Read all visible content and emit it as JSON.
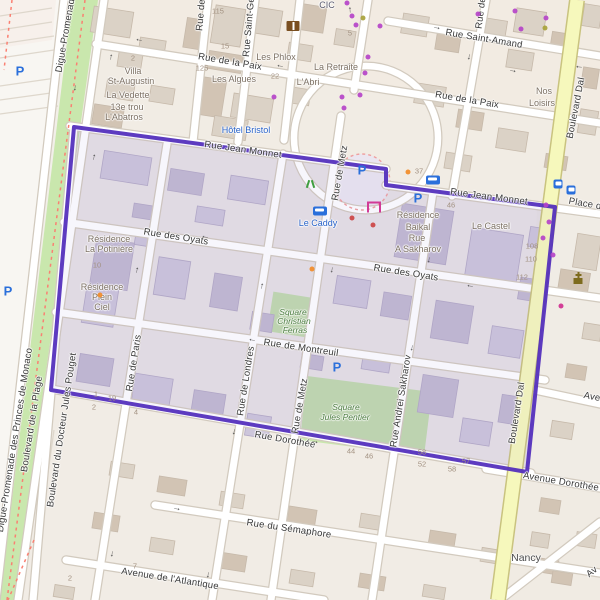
{
  "map_type": "street-map",
  "colors": {
    "background": "#f2efe9",
    "boundary_purple": "#5531bd",
    "boundary_fill": "rgba(126,110,198,0.10)",
    "major_road_yellow": "#f6f8bc",
    "park_green": "#c9e7ad",
    "poi_blue": "#2862c8",
    "building_outside": "#dbd2c6",
    "building_inside": "#cdc6db"
  },
  "glyphs": {
    "oneway_arrow": "→",
    "parking": "P"
  },
  "labels": [
    {
      "text": "Rue Saint-Amand",
      "x": 484,
      "y": 39,
      "rot": 9.5,
      "cls": "st"
    },
    {
      "text": "Rue de la Paix",
      "x": 230,
      "y": 62,
      "rot": 9.5,
      "cls": "st"
    },
    {
      "text": "Rue de la Paix",
      "x": 467,
      "y": 100,
      "rot": 9.5,
      "cls": "st"
    },
    {
      "text": "Rue Jean Monnet",
      "x": 243,
      "y": 150,
      "rot": 8,
      "cls": "st"
    },
    {
      "text": "Rue Jean Monnet",
      "x": 489,
      "y": 197,
      "rot": 7.5,
      "cls": "st"
    },
    {
      "text": "Place d",
      "x": 585,
      "y": 204,
      "rot": 10,
      "cls": "st"
    },
    {
      "text": "Rue des Oyats",
      "x": 176,
      "y": 237,
      "rot": 9,
      "cls": "st"
    },
    {
      "text": "Rue des Oyats",
      "x": 406,
      "y": 273,
      "rot": 9,
      "cls": "st"
    },
    {
      "text": "Rue de Montreuil",
      "x": 301,
      "y": 348,
      "rot": 8.5,
      "cls": "st"
    },
    {
      "text": "Rue Dorothée",
      "x": 285,
      "y": 440,
      "rot": 10,
      "cls": "st"
    },
    {
      "text": "Avenue Dorothée",
      "x": 561,
      "y": 482,
      "rot": 9.5,
      "cls": "st"
    },
    {
      "text": "Ave",
      "x": 592,
      "y": 397,
      "rot": 11,
      "cls": "st"
    },
    {
      "text": "Rue du Sémaphore",
      "x": 289,
      "y": 529,
      "rot": 8.5,
      "cls": "st"
    },
    {
      "text": "Avenue de l'Atlantique",
      "x": 170,
      "y": 579,
      "rot": 9,
      "cls": "st"
    },
    {
      "text": "Av",
      "x": 592,
      "y": 572,
      "rot": -38,
      "cls": "st"
    },
    {
      "text": "Digue-Promenade",
      "x": 66,
      "y": 33,
      "rot": -80,
      "cls": "st"
    },
    {
      "text": "Digue-Promenade des Princes de Monaco",
      "x": 15,
      "y": 440,
      "rot": -81,
      "cls": "st"
    },
    {
      "text": "Boulevard de la Plage",
      "x": 32,
      "y": 424,
      "rot": -81,
      "cls": "st"
    },
    {
      "text": "Boulevard du Docteur Jules Pouget",
      "x": 62,
      "y": 430,
      "rot": -81.5,
      "cls": "st"
    },
    {
      "text": "Rue de Paris",
      "x": 134,
      "y": 363,
      "rot": -81,
      "cls": "st"
    },
    {
      "text": "Rue de Londres",
      "x": 246,
      "y": 381,
      "rot": -81,
      "cls": "st"
    },
    {
      "text": "Rue de Metz",
      "x": 340,
      "y": 173,
      "rot": -80,
      "cls": "st"
    },
    {
      "text": "Rue de Metz",
      "x": 300,
      "y": 406,
      "rot": -80,
      "cls": "st"
    },
    {
      "text": "Rue Andrei Sakharov",
      "x": 401,
      "y": 401,
      "rot": -81,
      "cls": "st"
    },
    {
      "text": "Rue Saint-Ge",
      "x": 249,
      "y": 27,
      "rot": -85,
      "cls": "st"
    },
    {
      "text": "Rue de",
      "x": 201,
      "y": 15,
      "rot": -85,
      "cls": "st"
    },
    {
      "text": "Rue de",
      "x": 481,
      "y": 13,
      "rot": -83,
      "cls": "st"
    },
    {
      "text": "Boulevard Dal",
      "x": 576,
      "y": 108,
      "rot": -79,
      "cls": "st"
    },
    {
      "text": "Boulevard Dal",
      "x": 517,
      "y": 413,
      "rot": -81,
      "cls": "st"
    },
    {
      "text": "Villa",
      "x": 133,
      "y": 71,
      "rot": 0,
      "cls": "poi"
    },
    {
      "text": "St-Augustin",
      "x": 131,
      "y": 81,
      "rot": 0,
      "cls": "poi"
    },
    {
      "text": "La Vedette",
      "x": 128,
      "y": 95,
      "rot": 0,
      "cls": "poi"
    },
    {
      "text": "13e trou",
      "x": 127,
      "y": 107,
      "rot": 0,
      "cls": "poi"
    },
    {
      "text": "L'Abatros",
      "x": 124,
      "y": 117,
      "rot": 0,
      "cls": "poi"
    },
    {
      "text": "Les Algues",
      "x": 234,
      "y": 79,
      "rot": 0,
      "cls": "poi"
    },
    {
      "text": "Les Phlox",
      "x": 276,
      "y": 57,
      "rot": 0,
      "cls": "poi"
    },
    {
      "text": "L'Abri",
      "x": 308,
      "y": 82,
      "rot": 0,
      "cls": "poi"
    },
    {
      "text": "La Retraite",
      "x": 336,
      "y": 67,
      "rot": 0,
      "cls": "poi"
    },
    {
      "text": "Nos",
      "x": 544,
      "y": 91,
      "rot": 0,
      "cls": "poi"
    },
    {
      "text": "Loisirs",
      "x": 542,
      "y": 103,
      "rot": 0,
      "cls": "poi"
    },
    {
      "text": "CIC",
      "x": 327,
      "y": 5,
      "rot": 0,
      "cls": "bank"
    },
    {
      "text": "Résidence",
      "x": 109,
      "y": 239,
      "rot": 0,
      "cls": "poi"
    },
    {
      "text": "La Potinière",
      "x": 109,
      "y": 249,
      "rot": 0,
      "cls": "poi"
    },
    {
      "text": "Résidence",
      "x": 102,
      "y": 287,
      "rot": 0,
      "cls": "poi"
    },
    {
      "text": "Plein",
      "x": 102,
      "y": 297,
      "rot": 0,
      "cls": "poi"
    },
    {
      "text": "Ciel",
      "x": 102,
      "y": 307,
      "rot": 0,
      "cls": "poi"
    },
    {
      "text": "Résidence",
      "x": 418,
      "y": 215,
      "rot": 0,
      "cls": "poi"
    },
    {
      "text": "Baikal",
      "x": 418,
      "y": 227,
      "rot": 0,
      "cls": "poi"
    },
    {
      "text": "Rue",
      "x": 417,
      "y": 238,
      "rot": 0,
      "cls": "poi"
    },
    {
      "text": "A Sakharov",
      "x": 418,
      "y": 249,
      "rot": 0,
      "cls": "poi"
    },
    {
      "text": "Le Castel",
      "x": 491,
      "y": 226,
      "rot": 0,
      "cls": "poi"
    },
    {
      "text": "Nancy",
      "x": 526,
      "y": 558,
      "rot": 0,
      "cls": "place"
    },
    {
      "text": "Hôtel Bristol",
      "x": 246,
      "y": 130,
      "rot": 0,
      "cls": "poib"
    },
    {
      "text": "Le Caddy",
      "x": 318,
      "y": 223,
      "rot": 0,
      "cls": "poib"
    },
    {
      "text": "Square",
      "x": 293,
      "y": 312,
      "rot": 0,
      "cls": "park"
    },
    {
      "text": "Christian",
      "x": 294,
      "y": 321,
      "rot": 0,
      "cls": "park"
    },
    {
      "text": "Ferras",
      "x": 295,
      "y": 330,
      "rot": 0,
      "cls": "park"
    },
    {
      "text": "Square",
      "x": 346,
      "y": 407,
      "rot": 0,
      "cls": "park"
    },
    {
      "text": "Jules Pentier",
      "x": 345,
      "y": 417,
      "rot": 0,
      "cls": "park"
    },
    {
      "text": "115",
      "x": 218,
      "y": 11,
      "rot": 0,
      "cls": "num"
    },
    {
      "text": "5",
      "x": 350,
      "y": 33,
      "rot": 0,
      "cls": "num"
    },
    {
      "text": "15",
      "x": 225,
      "y": 46,
      "rot": 0,
      "cls": "num"
    },
    {
      "text": "2",
      "x": 133,
      "y": 58,
      "rot": 0,
      "cls": "num"
    },
    {
      "text": "125",
      "x": 202,
      "y": 68,
      "rot": 0,
      "cls": "num"
    },
    {
      "text": "22",
      "x": 275,
      "y": 76,
      "rot": 0,
      "cls": "num"
    },
    {
      "text": "37",
      "x": 419,
      "y": 171,
      "rot": 0,
      "cls": "num"
    },
    {
      "text": "46",
      "x": 451,
      "y": 205,
      "rot": 0,
      "cls": "num"
    },
    {
      "text": "108",
      "x": 532,
      "y": 246,
      "rot": 0,
      "cls": "num"
    },
    {
      "text": "110",
      "x": 531,
      "y": 259,
      "rot": 0,
      "cls": "num"
    },
    {
      "text": "112",
      "x": 522,
      "y": 277,
      "rot": 0,
      "cls": "num"
    },
    {
      "text": "10",
      "x": 97,
      "y": 265,
      "rot": 0,
      "cls": "num"
    },
    {
      "text": "1",
      "x": 96,
      "y": 394,
      "rot": 0,
      "cls": "num"
    },
    {
      "text": "19",
      "x": 112,
      "y": 398,
      "rot": 0,
      "cls": "num"
    },
    {
      "text": "2",
      "x": 94,
      "y": 407,
      "rot": 0,
      "cls": "num"
    },
    {
      "text": "4",
      "x": 136,
      "y": 412,
      "rot": 0,
      "cls": "num"
    },
    {
      "text": "44",
      "x": 351,
      "y": 451,
      "rot": 0,
      "cls": "num"
    },
    {
      "text": "46",
      "x": 369,
      "y": 456,
      "rot": 0,
      "cls": "num"
    },
    {
      "text": "58",
      "x": 422,
      "y": 452,
      "rot": 0,
      "cls": "num"
    },
    {
      "text": "52",
      "x": 422,
      "y": 464,
      "rot": 0,
      "cls": "num"
    },
    {
      "text": "57",
      "x": 466,
      "y": 461,
      "rot": 0,
      "cls": "num"
    },
    {
      "text": "58",
      "x": 452,
      "y": 469,
      "rot": 0,
      "cls": "num"
    },
    {
      "text": "7",
      "x": 135,
      "y": 566,
      "rot": 0,
      "cls": "num"
    },
    {
      "text": "2",
      "x": 70,
      "y": 578,
      "rot": 0,
      "cls": "num"
    }
  ],
  "icons": [
    {
      "name": "parking",
      "glyph": "P",
      "x": 20,
      "y": 71
    },
    {
      "name": "parking",
      "glyph": "P",
      "x": 8,
      "y": 291
    },
    {
      "name": "parking",
      "glyph": "P",
      "x": 362,
      "y": 170
    },
    {
      "name": "parking",
      "glyph": "P",
      "x": 418,
      "y": 198
    },
    {
      "name": "parking",
      "glyph": "P",
      "x": 337,
      "y": 367
    },
    {
      "name": "tram-stop",
      "x": 433,
      "y": 180
    },
    {
      "name": "tram-stop",
      "x": 320,
      "y": 211
    },
    {
      "name": "bus-stop",
      "x": 558,
      "y": 184
    },
    {
      "name": "bus-stop",
      "x": 571,
      "y": 190
    },
    {
      "name": "library",
      "x": 293,
      "y": 26
    },
    {
      "name": "church",
      "x": 578,
      "y": 277
    },
    {
      "name": "playground",
      "x": 310,
      "y": 184
    },
    {
      "name": "monument",
      "x": 374,
      "y": 207
    }
  ],
  "arrows": [
    {
      "x": 139,
      "y": 41,
      "rot": 189
    },
    {
      "x": 110,
      "y": 57,
      "rot": -84
    },
    {
      "x": 76,
      "y": 88,
      "rot": 96
    },
    {
      "x": 93,
      "y": 157,
      "rot": -81
    },
    {
      "x": 280,
      "y": 67,
      "rot": 189
    },
    {
      "x": 437,
      "y": 27,
      "rot": 9
    },
    {
      "x": 470,
      "y": 57,
      "rot": 97
    },
    {
      "x": 513,
      "y": 70,
      "rot": 9
    },
    {
      "x": 579,
      "y": 68,
      "rot": 185
    },
    {
      "x": 349,
      "y": 10,
      "rot": -93
    },
    {
      "x": 205,
      "y": 238,
      "rot": 189
    },
    {
      "x": 470,
      "y": 287,
      "rot": 189
    },
    {
      "x": 252,
      "y": 341,
      "rot": 189
    },
    {
      "x": 333,
      "y": 270,
      "rot": 98
    },
    {
      "x": 136,
      "y": 270,
      "rot": -81
    },
    {
      "x": 261,
      "y": 286,
      "rot": -83
    },
    {
      "x": 430,
      "y": 260,
      "rot": 98
    },
    {
      "x": 413,
      "y": 348,
      "rot": 98
    },
    {
      "x": 235,
      "y": 432,
      "rot": 99
    },
    {
      "x": 315,
      "y": 441,
      "rot": 10
    },
    {
      "x": 177,
      "y": 508,
      "rot": 9
    },
    {
      "x": 113,
      "y": 554,
      "rot": 97
    },
    {
      "x": 209,
      "y": 575,
      "rot": 97
    }
  ],
  "dots": [
    {
      "x": 347,
      "y": 3,
      "c": "#b543c8"
    },
    {
      "x": 352,
      "y": 16,
      "c": "#b543c8"
    },
    {
      "x": 356,
      "y": 25,
      "c": "#b543c8"
    },
    {
      "x": 380,
      "y": 26,
      "c": "#b543c8"
    },
    {
      "x": 368,
      "y": 57,
      "c": "#b543c8"
    },
    {
      "x": 365,
      "y": 73,
      "c": "#b543c8"
    },
    {
      "x": 342,
      "y": 97,
      "c": "#b543c8"
    },
    {
      "x": 360,
      "y": 95,
      "c": "#b543c8"
    },
    {
      "x": 344,
      "y": 108,
      "c": "#b543c8"
    },
    {
      "x": 274,
      "y": 97,
      "c": "#b543c8"
    },
    {
      "x": 478,
      "y": 14,
      "c": "#b543c8"
    },
    {
      "x": 515,
      "y": 11,
      "c": "#b543c8"
    },
    {
      "x": 521,
      "y": 29,
      "c": "#b543c8"
    },
    {
      "x": 546,
      "y": 18,
      "c": "#b543c8"
    },
    {
      "x": 546,
      "y": 205,
      "c": "#b543c8"
    },
    {
      "x": 549,
      "y": 222,
      "c": "#b543c8"
    },
    {
      "x": 543,
      "y": 238,
      "c": "#b543c8"
    },
    {
      "x": 553,
      "y": 255,
      "c": "#b543c8"
    },
    {
      "x": 363,
      "y": 18,
      "c": "#a8a23a"
    },
    {
      "x": 545,
      "y": 28,
      "c": "#a8a23a"
    },
    {
      "x": 408,
      "y": 172,
      "c": "#f28c28"
    },
    {
      "x": 100,
      "y": 295,
      "c": "#f28c28"
    },
    {
      "x": 312,
      "y": 269,
      "c": "#f28c28"
    },
    {
      "x": 352,
      "y": 218,
      "c": "#cc4444"
    },
    {
      "x": 373,
      "y": 225,
      "c": "#cc4444"
    },
    {
      "x": 561,
      "y": 306,
      "c": "#d03090"
    }
  ]
}
